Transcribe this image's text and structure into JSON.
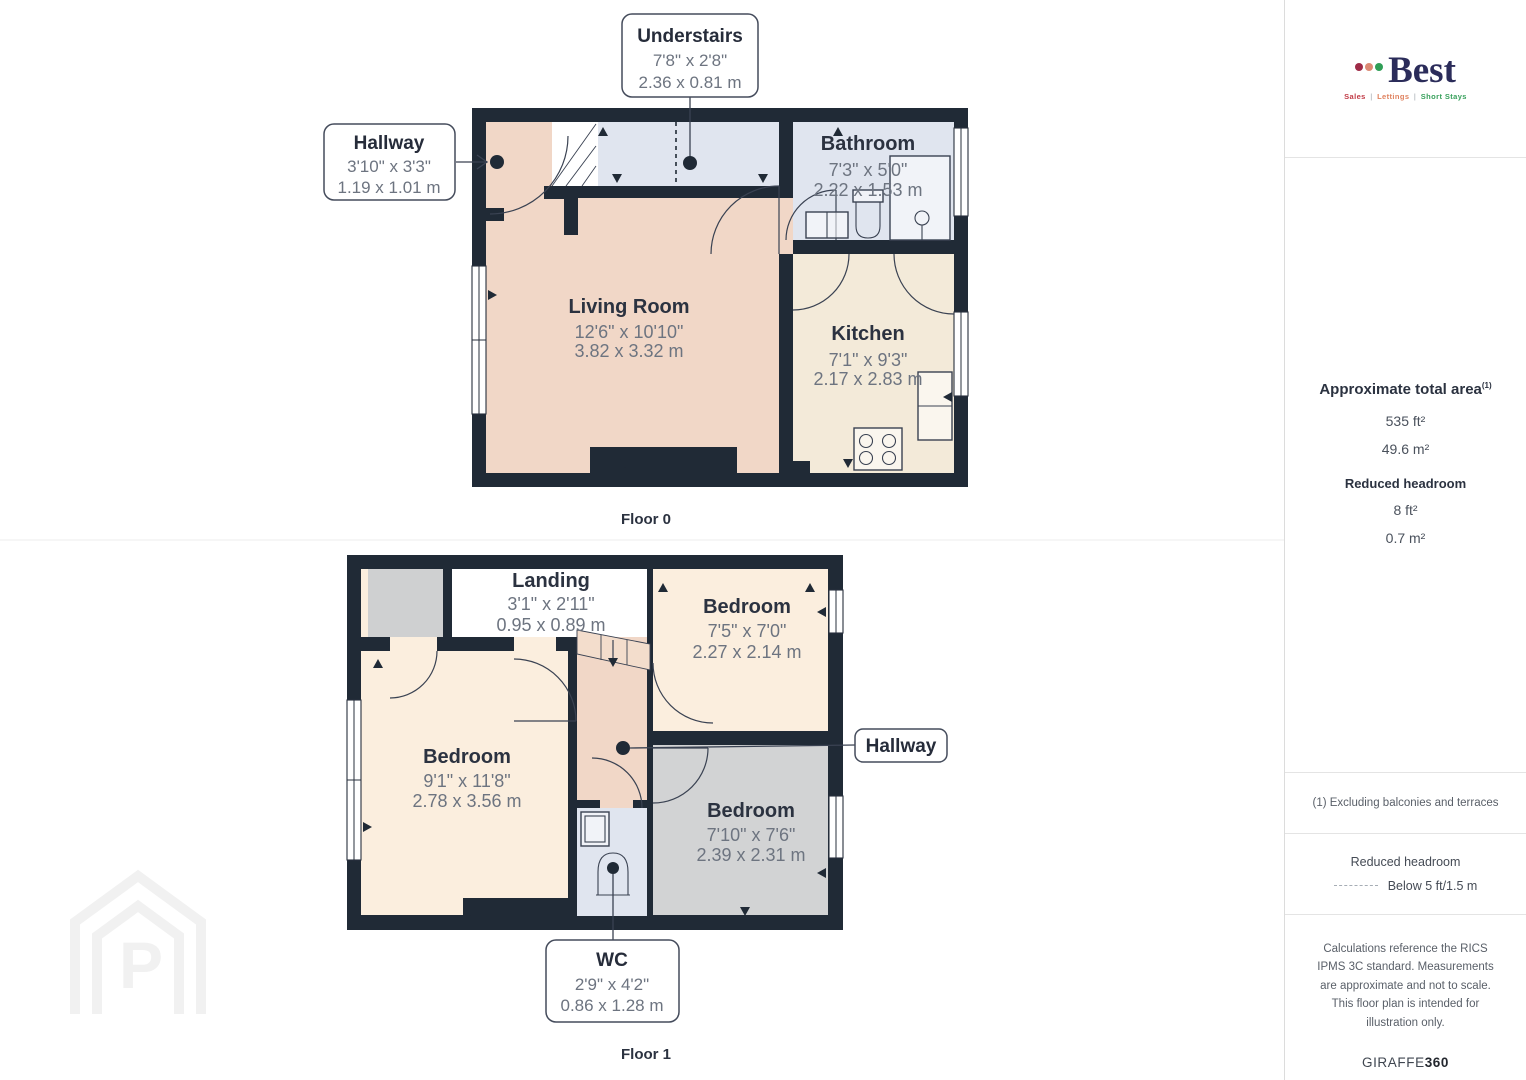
{
  "colors": {
    "wall": "#202a36",
    "living_floor": "#f1d7c7",
    "kitchen_floor": "#f3ead9",
    "bath_floor": "#e0e5ef",
    "bedroom_floor": "#fbeede",
    "gray_room_floor": "#d2d3d4",
    "closet_floor": "#cfd0d1",
    "stairs_fill": "#f3ddcc",
    "logo_navy": "#2b2c5a",
    "accent_red": "#c13a45",
    "accent_orange": "#e0825f",
    "accent_green": "#37a05b",
    "dim_text": "#6d7480",
    "name_text": "#2b3240"
  },
  "floor0": {
    "caption": "Floor 0",
    "rooms": {
      "hallway": {
        "name": "Hallway",
        "imperial": "3'10\" x 3'3\"",
        "metric": "1.19 x 1.01 m"
      },
      "understairs": {
        "name": "Understairs",
        "imperial": "7'8\" x 2'8\"",
        "metric": "2.36 x 0.81 m"
      },
      "bathroom": {
        "name": "Bathroom",
        "imperial": "7'3\" x 5'0\"",
        "metric": "2.22 x 1.53 m"
      },
      "living_room": {
        "name": "Living Room",
        "imperial": "12'6\" x 10'10\"",
        "metric": "3.82 x 3.32 m"
      },
      "kitchen": {
        "name": "Kitchen",
        "imperial": "7'1\" x 9'3\"",
        "metric": "2.17 x 2.83 m"
      }
    }
  },
  "floor1": {
    "caption": "Floor 1",
    "rooms": {
      "landing": {
        "name": "Landing",
        "imperial": "3'1\" x 2'11\"",
        "metric": "0.95 x 0.89 m"
      },
      "bedroom_top_right": {
        "name": "Bedroom",
        "imperial": "7'5\" x 7'0\"",
        "metric": "2.27 x 2.14 m"
      },
      "bedroom_left": {
        "name": "Bedroom",
        "imperial": "9'1\" x 11'8\"",
        "metric": "2.78 x 3.56 m"
      },
      "bedroom_bottom_right": {
        "name": "Bedroom",
        "imperial": "7'10\" x 7'6\"",
        "metric": "2.39 x 2.31 m"
      },
      "hallway": {
        "name": "Hallway"
      },
      "wc": {
        "name": "WC",
        "imperial": "2'9\" x 4'2\"",
        "metric": "0.86 x 1.28 m"
      }
    }
  },
  "sidebar": {
    "logo": {
      "name": "Best",
      "tagline_sales": "Sales",
      "tagline_lettings": "Lettings",
      "tagline_short_stays": "Short Stays",
      "tagline_sep": "|"
    },
    "area": {
      "title": "Approximate total area",
      "title_sup": "(1)",
      "total_imperial": "535 ft²",
      "total_metric": "49.6 m²",
      "reduced_title": "Reduced headroom",
      "reduced_imperial": "8 ft²",
      "reduced_metric": "0.7 m²"
    },
    "notes": {
      "exclusion": "(1) Excluding balconies and terraces",
      "legend_title": "Reduced headroom",
      "legend_value": "Below 5 ft/1.5 m",
      "disclaimer": "Calculations reference the RICS IPMS 3C standard. Measurements are approximate and not to scale. This floor plan is intended for illustration only.",
      "brand": "GIRAFFE",
      "brand_suffix": "360"
    }
  },
  "watermark": {
    "letter": "P"
  }
}
